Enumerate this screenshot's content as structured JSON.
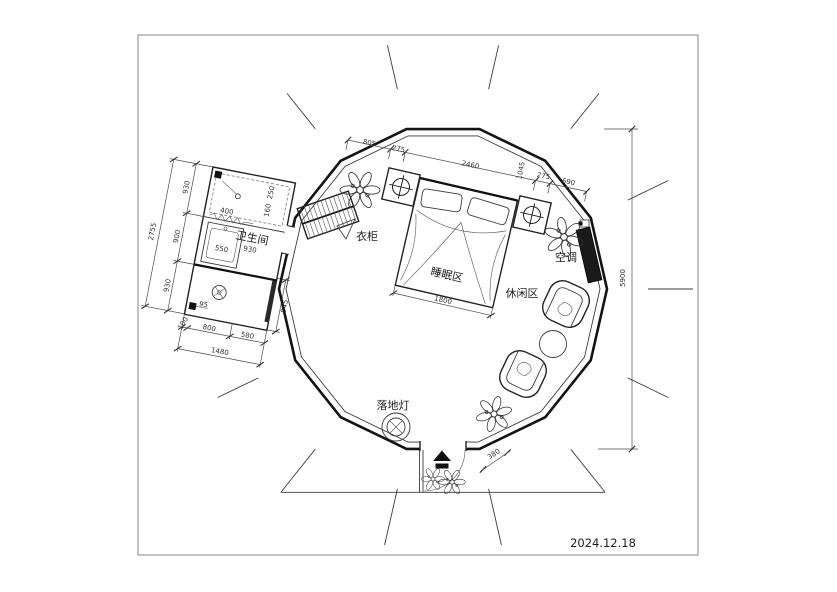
{
  "labels": {
    "bathroom": "卫生间",
    "wardrobe": "衣柜",
    "sleeping_area": "睡眠区",
    "leisure_area": "休闲区",
    "air_conditioner": "空调",
    "floor_lamp": "落地灯"
  },
  "date": "2024.12.18",
  "dims": {
    "overall": "5900",
    "top": [
      "805",
      "275",
      "2460",
      "1045",
      "275",
      "690"
    ],
    "bed_width": "1800",
    "door": "380",
    "bath_left": [
      "930",
      "900",
      "930"
    ],
    "bath_left_total": "2755",
    "bath_bottom": [
      "100",
      "800",
      "580"
    ],
    "bath_bottom_total": "1480",
    "bath_diag": "945",
    "bath_inner": [
      "400",
      "250",
      "160",
      "550",
      "930",
      "95"
    ]
  },
  "colors": {
    "line": "#141414",
    "dimension": "#4a4a4a",
    "background": "#ffffff"
  }
}
